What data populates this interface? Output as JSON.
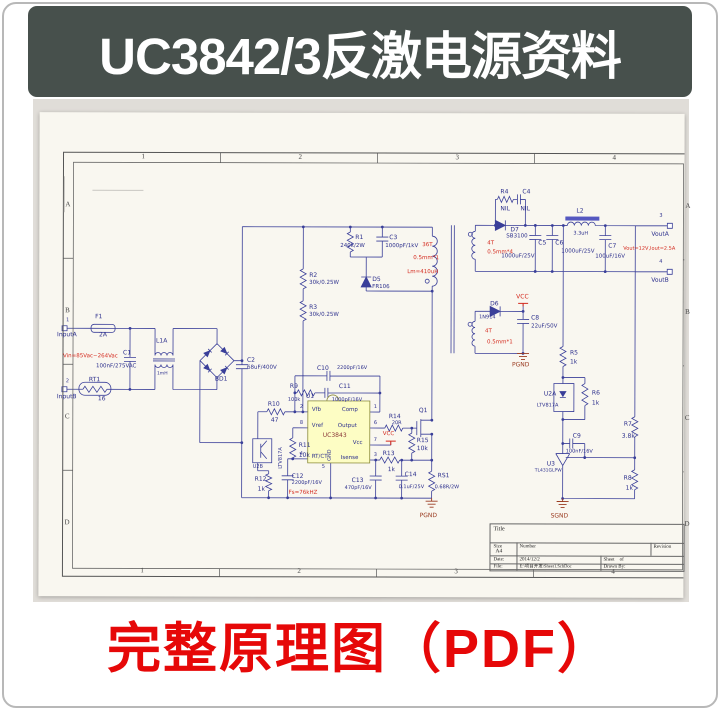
{
  "banner": {
    "title": "UC3842/3反激电源资料"
  },
  "caption": {
    "text": "完整原理图（PDF）"
  },
  "colors": {
    "banner_bg": "#47504c",
    "caption_red": "#e60808",
    "wire_blue": "#3a3f99",
    "ic_yellow": "#fdfdc4"
  },
  "schematic": {
    "grid": {
      "cols": [
        "1",
        "2",
        "3",
        "4"
      ],
      "rows": [
        "A",
        "B",
        "C",
        "D"
      ]
    },
    "title_block": {
      "title_label": "Title",
      "size_label": "Size",
      "size_value": "A4",
      "number_label": "Number",
      "revision_label": "Revision",
      "date_label": "Date:",
      "date_value": "2014/12/2",
      "sheet_label": "Sheet    of",
      "file_label": "File:",
      "file_value": "E:\\项目开发\\Sheet1.SchDoc",
      "drawn_label": "Drawn By:"
    },
    "labels": [
      {
        "t": "F1",
        "x": 56,
        "y": 202
      },
      {
        "t": "2A",
        "x": 60,
        "y": 220
      },
      {
        "t": "InputA",
        "x": 18,
        "y": 220
      },
      {
        "t": "1",
        "x": 27,
        "y": 206,
        "s": 5
      },
      {
        "t": "2",
        "x": 27,
        "y": 267,
        "s": 5
      },
      {
        "t": "InputB",
        "x": 18,
        "y": 282
      },
      {
        "t": "Vin=85Vac~264Vac",
        "x": 24,
        "y": 242,
        "c": "r",
        "s": 5.5
      },
      {
        "t": "C1",
        "x": 84,
        "y": 238
      },
      {
        "t": "100nF/275VAC",
        "x": 57,
        "y": 252,
        "s": 5.5
      },
      {
        "t": "L1A",
        "x": 117,
        "y": 226
      },
      {
        "t": "1mH",
        "x": 118,
        "y": 260,
        "s": 4.5
      },
      {
        "t": "RT1",
        "x": 50,
        "y": 265
      },
      {
        "t": "16",
        "x": 59,
        "y": 284
      },
      {
        "t": "BD1",
        "x": 176,
        "y": 264
      },
      {
        "t": "C2",
        "x": 208,
        "y": 245
      },
      {
        "t": "68uF/400V",
        "x": 208,
        "y": 253,
        "s": 5.5
      },
      {
        "t": "R1",
        "x": 316,
        "y": 122
      },
      {
        "t": "240k/2W",
        "x": 301,
        "y": 131,
        "s": 5.5
      },
      {
        "t": "C3",
        "x": 350,
        "y": 122
      },
      {
        "t": "1000pF/1kV",
        "x": 346,
        "y": 131,
        "s": 5.5
      },
      {
        "t": "D5",
        "x": 333,
        "y": 164
      },
      {
        "t": "FR106",
        "x": 333,
        "y": 172,
        "s": 5.5
      },
      {
        "t": "R2",
        "x": 270,
        "y": 160
      },
      {
        "t": "30k/0.25W",
        "x": 270,
        "y": 168,
        "s": 5.5
      },
      {
        "t": "R3",
        "x": 270,
        "y": 192
      },
      {
        "t": "30k/0.25W",
        "x": 270,
        "y": 200,
        "s": 5.5
      },
      {
        "t": "36T",
        "x": 383,
        "y": 130,
        "c": "r",
        "s": 5.5
      },
      {
        "t": "0.5mm*1",
        "x": 374,
        "y": 143,
        "c": "r",
        "s": 5.5
      },
      {
        "t": "Lm=410uH",
        "x": 368,
        "y": 157,
        "c": "r",
        "s": 5.5
      },
      {
        "t": "4T",
        "x": 448,
        "y": 128,
        "c": "r",
        "s": 5.5
      },
      {
        "t": "0.5mm*4",
        "x": 448,
        "y": 137,
        "c": "r",
        "s": 5.5
      },
      {
        "t": "R4",
        "x": 461,
        "y": 76
      },
      {
        "t": "NIL",
        "x": 461,
        "y": 93
      },
      {
        "t": "C4",
        "x": 483,
        "y": 76
      },
      {
        "t": "NIL",
        "x": 481,
        "y": 93
      },
      {
        "t": "D7",
        "x": 471,
        "y": 114
      },
      {
        "t": "SB3100",
        "x": 467,
        "y": 121,
        "s": 5.5
      },
      {
        "t": "L2",
        "x": 537,
        "y": 95
      },
      {
        "t": "3.3uH",
        "x": 534,
        "y": 118,
        "s": 5
      },
      {
        "t": "C5",
        "x": 499,
        "y": 127
      },
      {
        "t": "1000uF/25V",
        "x": 462,
        "y": 141,
        "s": 5.5
      },
      {
        "t": "C6",
        "x": 516,
        "y": 127
      },
      {
        "t": "1000uF/25V",
        "x": 522,
        "y": 136,
        "s": 5.5
      },
      {
        "t": "C7",
        "x": 569,
        "y": 130
      },
      {
        "t": "100uF/16V",
        "x": 556,
        "y": 141,
        "s": 5.5
      },
      {
        "t": "VoutA",
        "x": 612,
        "y": 118
      },
      {
        "t": "3",
        "x": 620,
        "y": 100,
        "s": 5
      },
      {
        "t": "Vout=12V,Iout=2.5A",
        "x": 584,
        "y": 133,
        "c": "r",
        "s": 5
      },
      {
        "t": "VoutB",
        "x": 612,
        "y": 164
      },
      {
        "t": "4",
        "x": 620,
        "y": 146,
        "s": 5
      },
      {
        "t": "D6",
        "x": 451,
        "y": 188
      },
      {
        "t": "1N914",
        "x": 440,
        "y": 202,
        "s": 5
      },
      {
        "t": "VCC",
        "x": 477,
        "y": 181,
        "c": "r"
      },
      {
        "t": "C8",
        "x": 492,
        "y": 202
      },
      {
        "t": "22uF/50V",
        "x": 492,
        "y": 211,
        "s": 5.5
      },
      {
        "t": "4T",
        "x": 446,
        "y": 216,
        "c": "r",
        "s": 5.5
      },
      {
        "t": "0.5mm*1",
        "x": 448,
        "y": 227,
        "c": "r",
        "s": 5.5
      },
      {
        "t": "PGND",
        "x": 473,
        "y": 249,
        "c": "g"
      },
      {
        "t": "R5",
        "x": 531,
        "y": 237
      },
      {
        "t": "1k",
        "x": 531,
        "y": 246
      },
      {
        "t": "U2A",
        "x": 505,
        "y": 278
      },
      {
        "t": "LTV817A",
        "x": 498,
        "y": 290,
        "s": 5
      },
      {
        "t": "R6",
        "x": 553,
        "y": 277
      },
      {
        "t": "1k",
        "x": 553,
        "y": 287
      },
      {
        "t": "R7",
        "x": 585,
        "y": 308
      },
      {
        "t": "3.8k",
        "x": 583,
        "y": 320
      },
      {
        "t": "C9",
        "x": 534,
        "y": 320
      },
      {
        "t": "100nF/16V",
        "x": 527,
        "y": 336,
        "s": 5
      },
      {
        "t": "U3",
        "x": 508,
        "y": 348
      },
      {
        "t": "TL431GLPW",
        "x": 496,
        "y": 356,
        "s": 4.5
      },
      {
        "t": "R8",
        "x": 585,
        "y": 362
      },
      {
        "t": "1k",
        "x": 587,
        "y": 372
      },
      {
        "t": "SGND",
        "x": 512,
        "y": 400,
        "c": "g"
      },
      {
        "t": "PGND",
        "x": 381,
        "y": 400,
        "c": "g"
      },
      {
        "t": "C10",
        "x": 278,
        "y": 253
      },
      {
        "t": "2200pF/16V",
        "x": 298,
        "y": 253,
        "s": 5
      },
      {
        "t": "R9",
        "x": 251,
        "y": 271
      },
      {
        "t": "100k",
        "x": 249,
        "y": 285,
        "s": 5
      },
      {
        "t": "C11",
        "x": 300,
        "y": 271
      },
      {
        "t": "1000pF/16V",
        "x": 293,
        "y": 285,
        "s": 5
      },
      {
        "t": "U1",
        "x": 267,
        "y": 281
      },
      {
        "t": "UC3843",
        "x": 284,
        "y": 320,
        "c": "m"
      },
      {
        "t": "R10",
        "x": 229,
        "y": 289
      },
      {
        "t": "47",
        "x": 232,
        "y": 305
      },
      {
        "t": "R11",
        "x": 260,
        "y": 330
      },
      {
        "t": "10k",
        "x": 260,
        "y": 340
      },
      {
        "t": "LTV817A",
        "x": 240,
        "y": 356,
        "v": 1,
        "s": 5
      },
      {
        "t": "U2B",
        "x": 214,
        "y": 352,
        "s": 5
      },
      {
        "t": "R12",
        "x": 216,
        "y": 364
      },
      {
        "t": "1k",
        "x": 219,
        "y": 374
      },
      {
        "t": "C12",
        "x": 253,
        "y": 361
      },
      {
        "t": "2200pF/16V",
        "x": 253,
        "y": 368,
        "s": 5
      },
      {
        "t": "Fs=76kHZ",
        "x": 250,
        "y": 378,
        "c": "r",
        "s": 5.5
      },
      {
        "t": "C13",
        "x": 313,
        "y": 365
      },
      {
        "t": "470pF/16V",
        "x": 306,
        "y": 373,
        "s": 5
      },
      {
        "t": "R13",
        "x": 344,
        "y": 338
      },
      {
        "t": "1k",
        "x": 349,
        "y": 354
      },
      {
        "t": "C14",
        "x": 366,
        "y": 359
      },
      {
        "t": "0.1uF/25V",
        "x": 360,
        "y": 372,
        "s": 5
      },
      {
        "t": "R15",
        "x": 378,
        "y": 325
      },
      {
        "t": "10k",
        "x": 378,
        "y": 333
      },
      {
        "t": "RS1",
        "x": 399,
        "y": 360
      },
      {
        "t": "0.68R/2W",
        "x": 396,
        "y": 372,
        "s": 5
      },
      {
        "t": "R14",
        "x": 350,
        "y": 301
      },
      {
        "t": "20R",
        "x": 353,
        "y": 308,
        "s": 5
      },
      {
        "t": "Q1",
        "x": 380,
        "y": 295
      },
      {
        "t": "VCC",
        "x": 344,
        "y": 319,
        "c": "r",
        "s": 5.5
      },
      {
        "t": "Vfb",
        "x": 273,
        "y": 295,
        "s": 5.5
      },
      {
        "t": "Comp",
        "x": 303,
        "y": 295,
        "s": 5.5
      },
      {
        "t": "Vref",
        "x": 273,
        "y": 311,
        "s": 5.5
      },
      {
        "t": "Output",
        "x": 299,
        "y": 311,
        "s": 5.5
      },
      {
        "t": "Vcc",
        "x": 314,
        "y": 328,
        "s": 5.5
      },
      {
        "t": "RT/CT",
        "x": 273,
        "y": 342,
        "s": 5.5
      },
      {
        "t": "Isense",
        "x": 302,
        "y": 343,
        "s": 5.5
      },
      {
        "t": "GND",
        "x": 289,
        "y": 348,
        "v": 1,
        "s": 5
      },
      {
        "t": "2",
        "x": 261,
        "y": 292,
        "s": 5
      },
      {
        "t": "8",
        "x": 261,
        "y": 308,
        "s": 5
      },
      {
        "t": "4",
        "x": 261,
        "y": 339,
        "s": 5
      },
      {
        "t": "1",
        "x": 335,
        "y": 292,
        "s": 5
      },
      {
        "t": "6",
        "x": 335,
        "y": 308,
        "s": 5
      },
      {
        "t": "7",
        "x": 335,
        "y": 325,
        "s": 5
      },
      {
        "t": "3",
        "x": 335,
        "y": 340,
        "s": 5
      },
      {
        "t": "5",
        "x": 283,
        "y": 352,
        "s": 5
      }
    ]
  }
}
